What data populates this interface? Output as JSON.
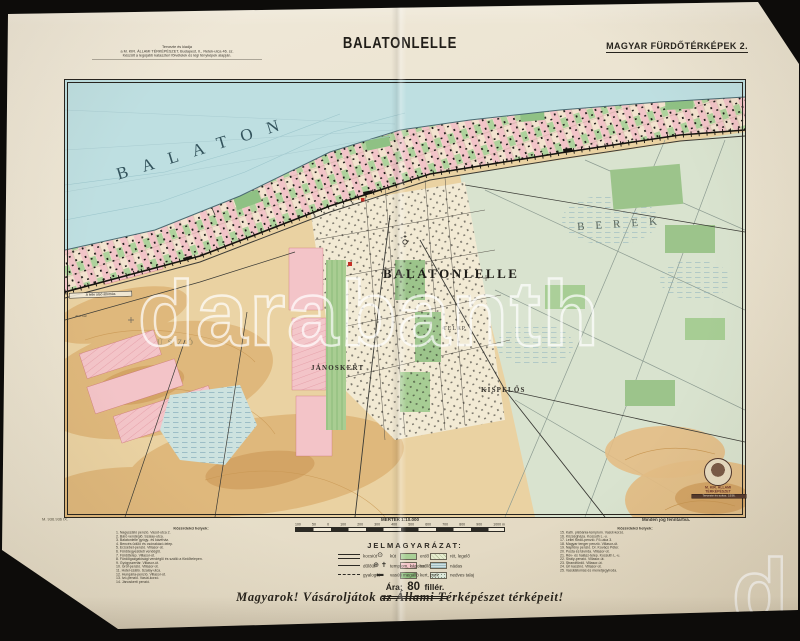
{
  "page": {
    "title": "BALATONLELLE",
    "series": "MAGYAR FÜRDŐTÉRKÉPEK 2.",
    "imprint_line1": "Tervezte és kiadja",
    "imprint_line2": "a M. KIR. ÁLLAMI TÉRKÉPÉSZET, Budapest, II., Retek-utca 46. sz.",
    "imprint_line3": "Készült a legújabb kataszteri fölvételek és légi fényképek alapján.",
    "print_code": "M. 936.936 IX.",
    "rights": "Minden jog fenntartva.",
    "slogan": "Magyarok! Vásároljátok az Állami Térképészet térképeit!"
  },
  "map": {
    "labels": {
      "lake": "BALATON",
      "town": "BALATONLELLE",
      "berek": "BEREK",
      "janoskert": "JÁNOSKERT",
      "kispelos": "KISPELŐS",
      "telep": "TELEP",
      "uszo": "ÚSZÓ",
      "station": "A lelle alsó állomás",
      "also_hat": "Alsó hát"
    },
    "emblem": {
      "line1": "M. KIR. ÁLLAMI",
      "line2": "TÉRKÉPÉSZET",
      "note": "Tervezte és soksz. 1936."
    }
  },
  "scale": {
    "label": "MÉRTÉK 1:10.000",
    "ticks": [
      "100",
      "50",
      "0",
      "100",
      "200",
      "300",
      "400",
      "500",
      "600",
      "700",
      "800",
      "900",
      "1000 m"
    ]
  },
  "legend": {
    "header": "JELMAGYARÁZAT:",
    "lines": [
      {
        "label": "kocsiút"
      },
      {
        "label": "dűlőút"
      },
      {
        "label": "gyalogút"
      }
    ],
    "symbols": [
      {
        "glyph": "⊙",
        "label": "kút"
      },
      {
        "glyph": "⊕ ✝",
        "label": "templom, kápolna"
      },
      {
        "glyph": "▬",
        "label": "vasúti megálló"
      }
    ],
    "areas_a": [
      {
        "label": "erdő",
        "color": "#a9cf96"
      },
      {
        "label": "szőlő",
        "color": "#f4c6ca"
      },
      {
        "label": "kert, park",
        "color": "#8fbf80"
      }
    ],
    "areas_b": [
      {
        "label": "rét, legelő",
        "color": "#e6eccf"
      },
      {
        "label": "nádas",
        "color": "#cfe2e4"
      },
      {
        "label": "nedves talaj",
        "color": "#dde8da"
      }
    ]
  },
  "price": {
    "label": "Ára:",
    "value": "80",
    "unit": "fillér."
  },
  "poi_left": {
    "header": "Közérdekű helyek:",
    "items": [
      "1. Nagyszálló penzió. Vasút-utca 2.",
      "2. Báró vendéglő. Szalay-utca.",
      "3. Balatonlelle gyógy- és kávéház.",
      "4. Bencés üdülő és csónakázó-telep.",
      "5. Erzsébet-penzió. Villasor-út.",
      "6. Fürdőegyesületi vendéglő.",
      "7. Fürdőtelep. Villasor-út.",
      "8. Fürdőigazgatósági vendéglő és szálló a fürdőtelepen.",
      "9. Gyógyszertár. Villasor-út.",
      "10. Gróf-penzió. Villasor-út.",
      "11. Hotel-szálló. Szalay-utca.",
      "12. Hungária-penzió. Villasor-út.",
      "13. Ivó-penzió. Vasút-korzó.",
      "14. Jánoskerti penzió."
    ]
  },
  "poi_right": {
    "header": "Közérdekű helyek:",
    "items": [
      "15. Kath. plébánia-templom. Vasút-korzó.",
      "16. Községháza. Kossuth L.-u.",
      "17. Lellei fürdő-penzió. Fő-utca 3.",
      "18. Magyar tenger penzió. Villasor-út.",
      "19. Napfény penzió. Dr. Kovács Péter.",
      "20. Posta és távírda. Villasor-út.",
      "21. Rév- és halász-telep. Kossuth L.-u.",
      "22. Sirály-penzió. Villasor-út.",
      "23. Strandfürdő. Villasor-út.",
      "24. Úri kaszinó. Villasor-út.",
      "25. Vasútállomás és menetjegyiroda."
    ]
  },
  "watermark": {
    "text": "darabanth",
    "partial_left": "h",
    "partial_right": "d"
  },
  "colors": {
    "paper": "#e9e1cd",
    "lake": "#bedfe1",
    "berek_green": "#d9e3cf",
    "field_tan": "#ead2a2",
    "vineyard_pink": "#f3c4c8",
    "park_green": "#9cc48b",
    "accent_red": "#c43127",
    "ink": "#26231e"
  }
}
